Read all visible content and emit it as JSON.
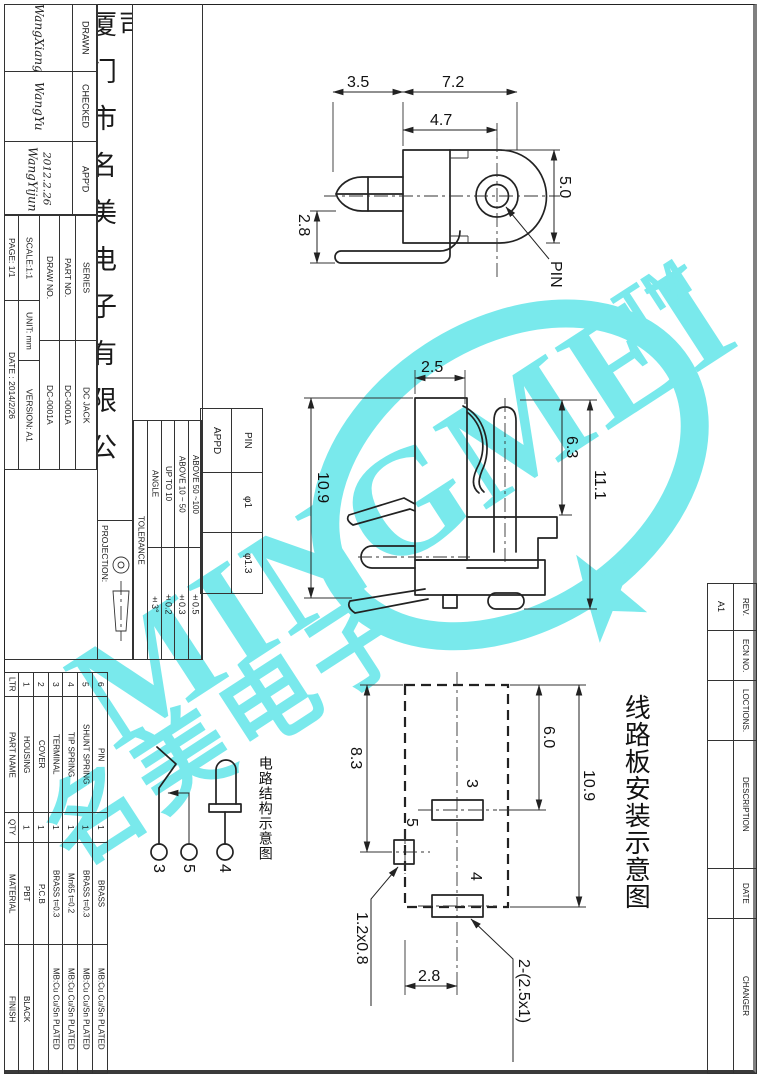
{
  "company": "厦门市名美电子有限公司",
  "title_block": {
    "drawn_label": "DRAWN",
    "drawn_sig": "WangXiang",
    "checked_label": "CHECKED",
    "checked_sig": "WangYu",
    "appd_label": "APP'D",
    "appd_sig": "WangYijun",
    "appd_date": "2012.2.26",
    "series_label": "SERIES",
    "series_value": "DC JACK",
    "part_no_label": "PART NO.",
    "part_no_value": "DC-0001A",
    "draw_no_label": "DRAW NO.",
    "draw_no_value": "DC-0001A",
    "scale": "SCALE:1:1",
    "unit": "UNIT: mm",
    "version": "VERSION: A1",
    "page": "PAGE: 1/1",
    "date": "DATE : 2014/2/26",
    "projection_label": "PROJECTION:"
  },
  "tolerance": {
    "header": "TOLERANCE",
    "rows": [
      {
        "label": "ANGLE",
        "value": "±3°"
      },
      {
        "label": "UP TO 10",
        "value": "±0.2"
      },
      {
        "label": "ABOVE 10 ~ 50",
        "value": "±0.3"
      },
      {
        "label": "ABOVE 50 ~100",
        "value": "±0.5"
      }
    ]
  },
  "pin_table": {
    "pin_header": "PIN",
    "appd_header": "APPD",
    "rows": [
      {
        "pin": "φ1",
        "appd": ""
      },
      {
        "pin": "φ1.3",
        "appd": ""
      }
    ]
  },
  "bom": {
    "headers": {
      "ltr": "LTR",
      "part_name": "PART NAME",
      "qty": "QTY",
      "material": "MATERIAL",
      "finish": "FINISH"
    },
    "items": [
      {
        "ltr": "1",
        "part_name": "HOUSING",
        "qty": "1",
        "material": "PBT",
        "finish": "BLACK"
      },
      {
        "ltr": "2",
        "part_name": "COVER",
        "qty": "1",
        "material": "P.C.B",
        "finish": ""
      },
      {
        "ltr": "3",
        "part_name": "TERMINAL",
        "qty": "1",
        "material": "BRASS t=0.3",
        "finish": "MB:Cu Cu/Sn PLATED"
      },
      {
        "ltr": "4",
        "part_name": "TIP SPRING",
        "qty": "1",
        "material": "Mn65 t=0.2",
        "finish": "MB:Cu Cu/Sn PLATED"
      },
      {
        "ltr": "5",
        "part_name": "SHUNT SPRING",
        "qty": "1",
        "material": "BRASS t=0.3",
        "finish": "MB:Cu Cu/Sn PLATED"
      },
      {
        "ltr": "6",
        "part_name": "PIN",
        "qty": "1",
        "material": "BRASS",
        "finish": "MB:Cu Cu/Sn PLATED"
      }
    ]
  },
  "revision": {
    "rows": [
      {
        "header": "REV.",
        "value": "A1"
      },
      {
        "header": "ECN NO.",
        "value": ""
      },
      {
        "header": "LOCTIONS.",
        "value": ""
      },
      {
        "header": "DESCRIPTION",
        "value": ""
      },
      {
        "header": "DATE",
        "value": ""
      },
      {
        "header": "CHANGER",
        "value": ""
      }
    ]
  },
  "views": {
    "top_view": {
      "dim_3_5": "3.5",
      "dim_7_2": "7.2",
      "dim_4_7": "4.7",
      "dim_5_0": "5.0",
      "dim_2_8": "2.8",
      "pin_label": "PIN"
    },
    "side_view": {
      "dim_2_5": "2.5",
      "dim_10_9": "10.9",
      "dim_6_3": "6.3",
      "dim_11_1": "11.1"
    },
    "pcb_view": {
      "caption": "线路板安装示意图",
      "dim_8_3": "8.3",
      "dim_6_0": "6.0",
      "dim_10_9": "10.9",
      "pad_3": "3",
      "pad_5": "5",
      "pad_4": "4",
      "slot_size": "1.2x0.8",
      "dim_2_8": "2.8",
      "holes": "2-(2.5x1)"
    },
    "schematic": {
      "caption": "电路结构示意图",
      "pin_3": "3",
      "pin_5": "5",
      "pin_4": "4"
    }
  },
  "watermark": {
    "brand": "MINGMEI",
    "tm": "TM",
    "cjk": "名美电子",
    "color": "#79e9ec"
  }
}
